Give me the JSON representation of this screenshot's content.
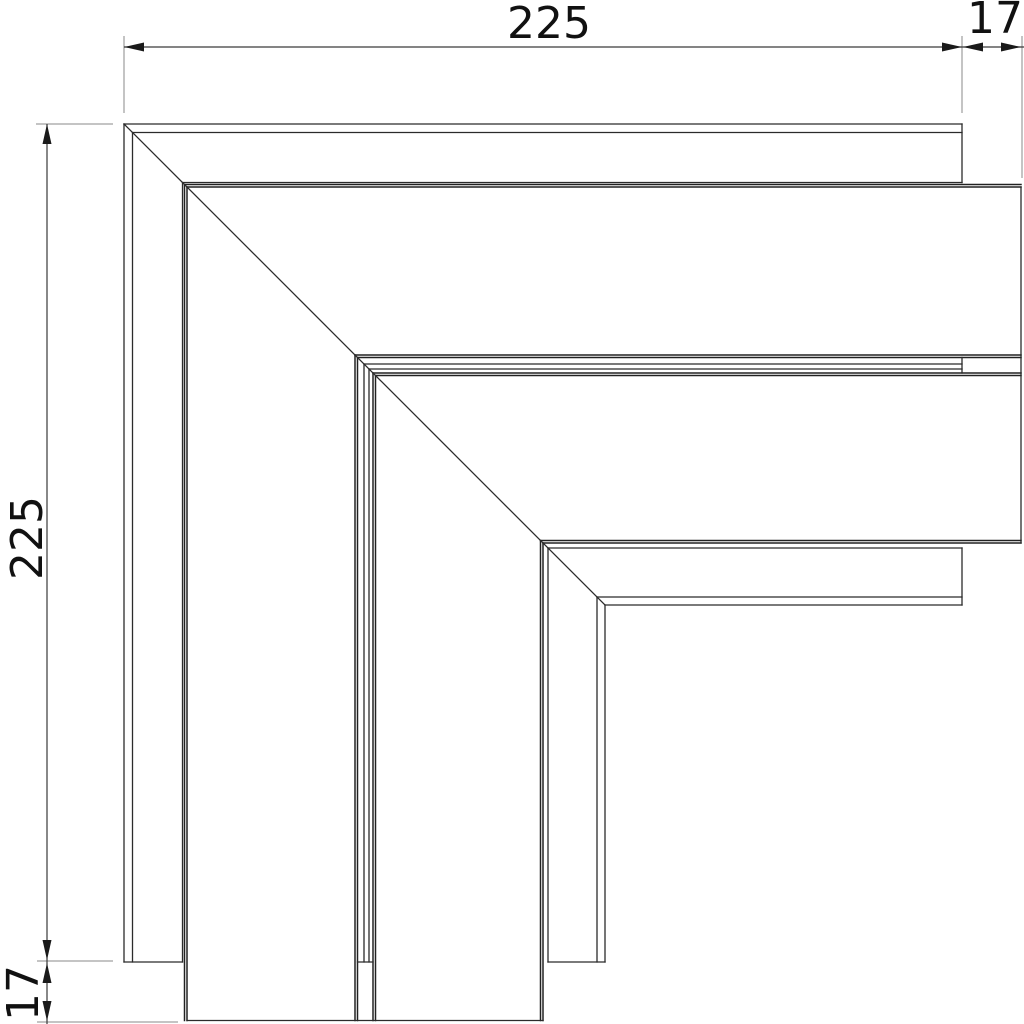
{
  "page": {
    "background": "#ffffff",
    "description": "Technical dimension drawing of a mitered flat-angle corner piece (plan view)"
  },
  "colors": {
    "piece_line": "#2b2b2b",
    "heavy_line": "#222222",
    "dim_line": "#3a3a3a",
    "ext_line": "#8a8a8a",
    "arrow": "#1a1a1a",
    "text": "#111111"
  },
  "dimensions": {
    "top_width": {
      "value": "225",
      "orientation": "horizontal"
    },
    "top_right_offset": {
      "value": "17",
      "orientation": "horizontal"
    },
    "left_height": {
      "value": "225",
      "orientation": "vertical"
    },
    "bottom_left_offset": {
      "value": "17",
      "orientation": "vertical"
    }
  }
}
